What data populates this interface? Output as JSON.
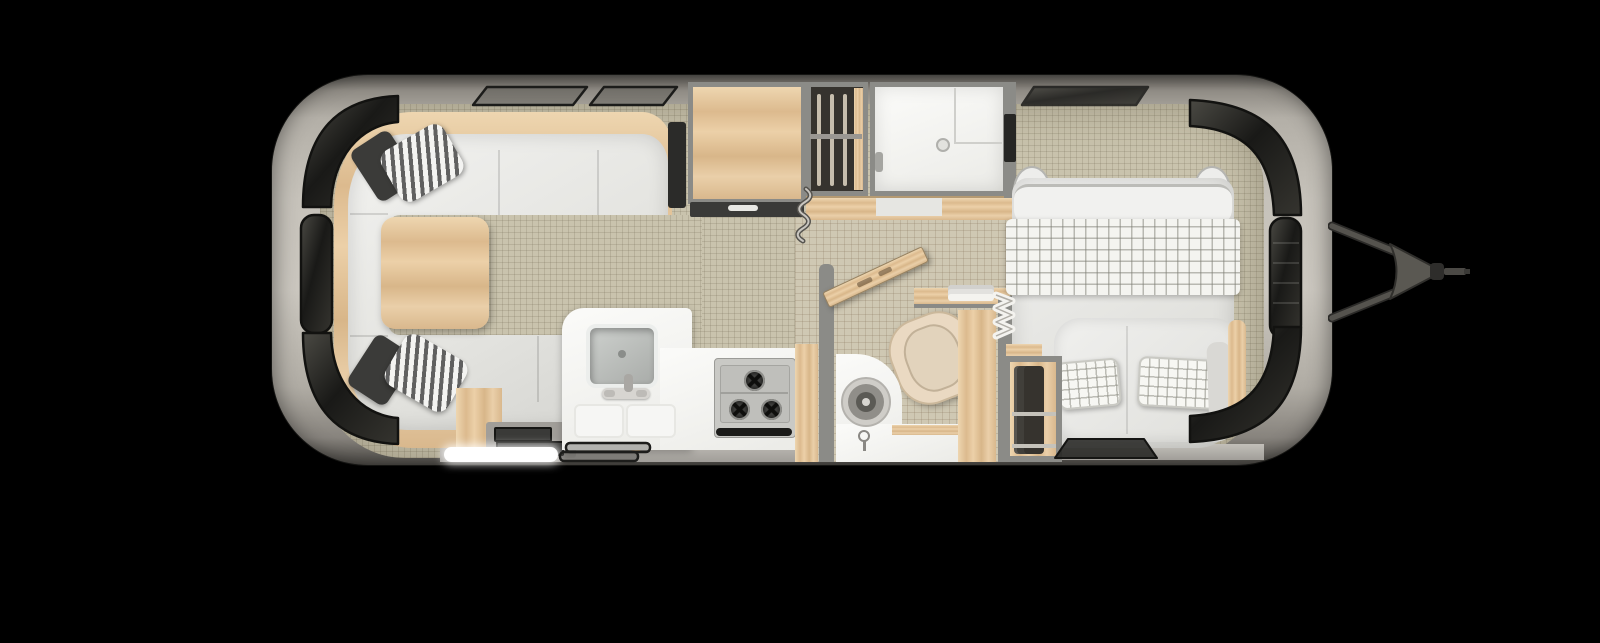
{
  "meta": {
    "description": "Top-down 3D rendered floor plan of a travel trailer on a black background",
    "canvas": {
      "width": 1600,
      "height": 643
    }
  },
  "colors": {
    "bg": "#000000",
    "hull-light": "#cbc7bf",
    "hull-mid": "#b3afa7",
    "hull-dark": "#45433f",
    "wall": "#8b8b87",
    "floor": "#c9c3ad",
    "tile": "#cfc8b3",
    "wood-light": "#ecd2ac",
    "wood-dark": "#d9b88d",
    "glass-dark": "#191917",
    "glass-mid": "#45443f",
    "sofa": "#e9e9e5",
    "cushion-dark": "#3b3b39",
    "stripe-dark": "#606060",
    "kitchen-white": "#f7f7f5",
    "stove": "#c9c9c5",
    "oven-handle": "#1b1b19",
    "toilet": "#ead9c2",
    "towel": "#f4f3ef",
    "clothes-dark": "#36332e",
    "bed-white": "#eeeeec",
    "hitch": "#55534e",
    "hitch-dark": "#2b2a28",
    "step-light": "#ffffff"
  },
  "scene": {
    "trailer": {
      "label": "Travel trailer floor plan, hitch at right"
    },
    "zones": [
      {
        "id": "front-dinette",
        "label": "Front wraparound dinette with wood table and striped pillows"
      },
      {
        "id": "galley",
        "label": "Galley with square sink, faucet and two-burner cooktop"
      },
      {
        "id": "pantry",
        "label": "Pantry / refrigerator cabinet with drawer below"
      },
      {
        "id": "wardrobe-front",
        "label": "Hanging wardrobe with clothes rail"
      },
      {
        "id": "shower",
        "label": "Shower stall with drain and bench"
      },
      {
        "id": "toilet-room",
        "label": "Toilet room with vanity, towel shelf and open wood door"
      },
      {
        "id": "wardrobe-rear",
        "label": "Rear wardrobe with hanging clothes"
      },
      {
        "id": "bedroom",
        "label": "Bedroom with bed, checkered blanket and plaid pillows"
      },
      {
        "id": "hitch",
        "label": "A-frame tow hitch and coupler"
      },
      {
        "id": "entry",
        "label": "Entry step with light"
      }
    ]
  }
}
